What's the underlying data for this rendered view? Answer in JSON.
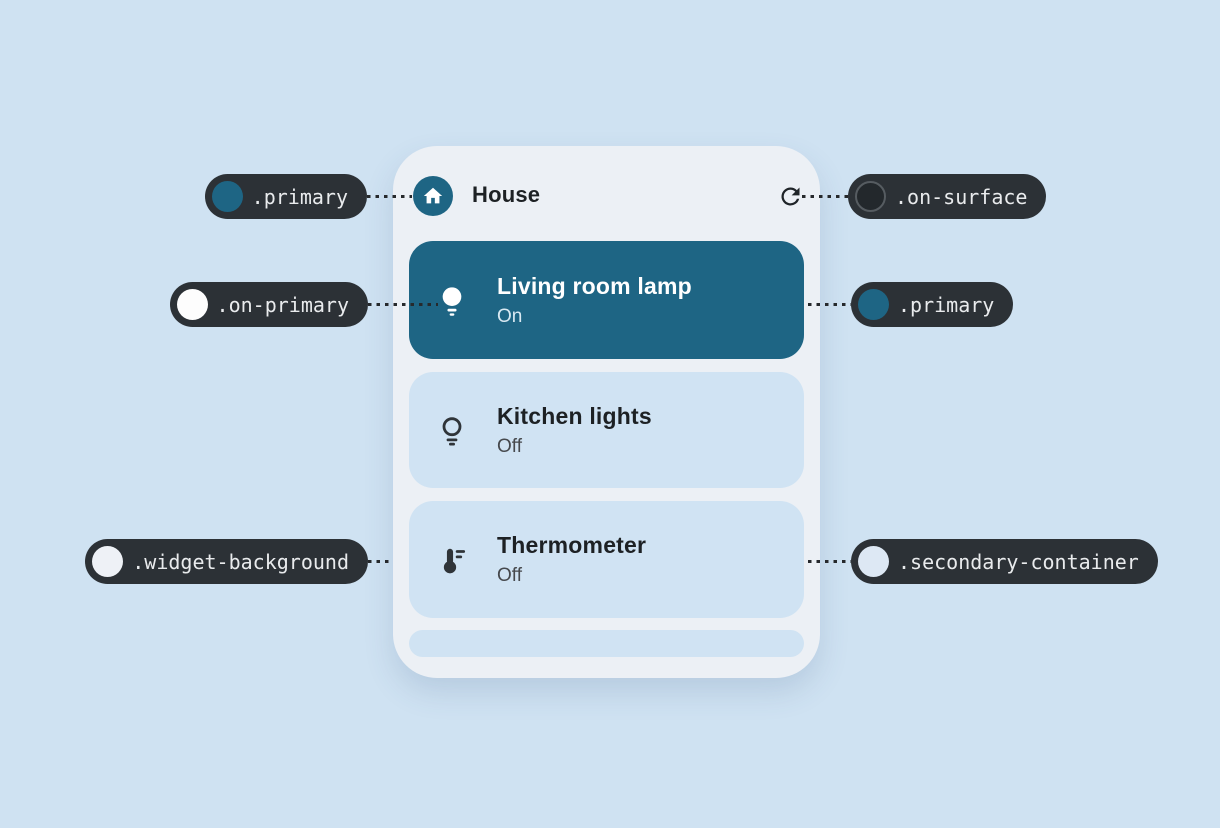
{
  "colors": {
    "page_background": "#cfe2f2",
    "widget_background": "#ecf0f5",
    "primary": "#1e6584",
    "on_primary": "#fdfdfd",
    "on_surface": "#23282c",
    "secondary_container": "#d0e3f3",
    "annotation_pill": "#2c3136",
    "swatch_widget_background": "#eef1f6",
    "swatch_secondary_container": "#dde8f4"
  },
  "widget": {
    "header": {
      "title": "House",
      "icon": "home-icon",
      "action_icon": "refresh-icon"
    },
    "cards": [
      {
        "title": "Living room lamp",
        "status": "On",
        "icon": "lightbulb-filled-icon",
        "variant": "primary"
      },
      {
        "title": "Kitchen lights",
        "status": "Off",
        "icon": "lightbulb-outline-icon",
        "variant": "secondary"
      },
      {
        "title": "Thermometer",
        "status": "Off",
        "icon": "thermometer-icon",
        "variant": "secondary"
      }
    ]
  },
  "annotations": {
    "left": [
      {
        "label": ".primary",
        "swatch": "#1e6584",
        "points_to": "header home icon"
      },
      {
        "label": ".on-primary",
        "swatch": "#fdfdfd",
        "points_to": "lamp icon on primary card"
      },
      {
        "label": ".widget-background",
        "swatch": "#eef1f6",
        "points_to": "widget surface"
      }
    ],
    "right": [
      {
        "label": ".on-surface",
        "swatch": "#23282c",
        "points_to": "refresh icon"
      },
      {
        "label": ".primary",
        "swatch": "#1e6584",
        "points_to": "active device card"
      },
      {
        "label": ".secondary-container",
        "swatch": "#dde8f4",
        "points_to": "inactive device card"
      }
    ]
  }
}
